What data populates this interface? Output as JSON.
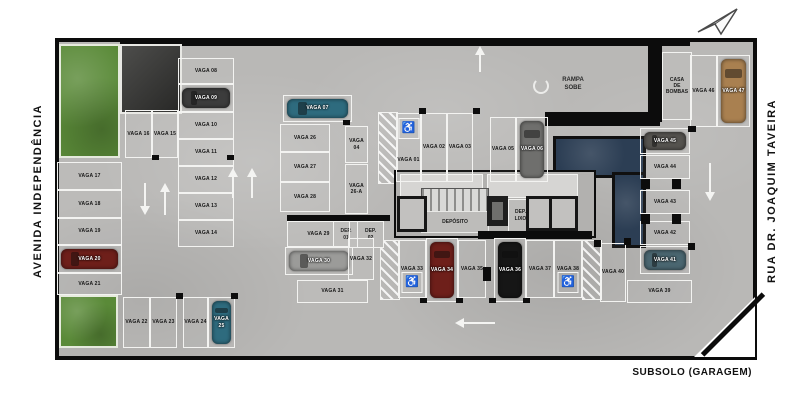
{
  "title": {
    "bottom_right": "SUBSOLO (GARAGEM)"
  },
  "streets": {
    "left": "AVENIDA INDEPENDÊNCIA",
    "right": "RUA DR. JOAQUIM TAVEIRA"
  },
  "labels": {
    "ramp_line1": "RAMPA",
    "ramp_line2": "SOBE",
    "pump_room_line1": "CASA",
    "pump_room_line2": "DE",
    "pump_room_line3": "BOMBAS",
    "deposito": "DEPÓSITO",
    "trash_line1": "DEP.",
    "trash_line2": "LIXO",
    "dep01_line1": "DEP.",
    "dep01_line2": "01",
    "dep02_line1": "DEP.",
    "dep02_line2": "02",
    "wheelchair_icon": "♿"
  },
  "colors": {
    "concrete": "#b9b8b6",
    "wall": "#0c0c0c",
    "grass": "#5a8a38",
    "water_tank": "#2c3e54",
    "space_line": "#f3f3f1",
    "car_red": "#6e1f1a",
    "car_teal": "#2e6b7e",
    "car_silver": "#9b9b99",
    "car_darkgray": "#3c3c3c",
    "car_black": "#161616",
    "car_tan": "#a98050",
    "car_steel": "#4a6670",
    "car_gray": "#6f6f6d",
    "car_darksilver": "#55534f"
  },
  "spaces": [
    {
      "label": "VAGA 01",
      "x": 396,
      "y": 113,
      "w": 25,
      "h": 69,
      "o": "v",
      "wc": "top"
    },
    {
      "label": "VAGA 02",
      "x": 421,
      "y": 113,
      "w": 26,
      "h": 69,
      "o": "v"
    },
    {
      "label": "VAGA 03",
      "x": 447,
      "y": 113,
      "w": 26,
      "h": 69,
      "o": "v"
    },
    {
      "label": "VAGA 04",
      "x": 345,
      "y": 126,
      "w": 23,
      "h": 37,
      "o": "v"
    },
    {
      "label": "VAGA 05",
      "x": 490,
      "y": 117,
      "w": 26,
      "h": 65,
      "o": "v"
    },
    {
      "label": "VAGA 06",
      "x": 516,
      "y": 117,
      "w": 32,
      "h": 65,
      "o": "v",
      "car": "car_gray"
    },
    {
      "label": "VAGA 07",
      "x": 283,
      "y": 95,
      "w": 69,
      "h": 27,
      "o": "h",
      "car": "car_teal"
    },
    {
      "label": "VAGA 08",
      "x": 178,
      "y": 58,
      "w": 56,
      "h": 26,
      "o": "h"
    },
    {
      "label": "VAGA 09",
      "x": 178,
      "y": 84,
      "w": 56,
      "h": 28,
      "o": "h",
      "car": "car_darkgray"
    },
    {
      "label": "VAGA 10",
      "x": 178,
      "y": 112,
      "w": 56,
      "h": 27,
      "o": "h"
    },
    {
      "label": "VAGA 11",
      "x": 178,
      "y": 139,
      "w": 56,
      "h": 27,
      "o": "h"
    },
    {
      "label": "VAGA 12",
      "x": 178,
      "y": 166,
      "w": 56,
      "h": 27,
      "o": "h"
    },
    {
      "label": "VAGA 13",
      "x": 178,
      "y": 193,
      "w": 56,
      "h": 27,
      "o": "h"
    },
    {
      "label": "VAGA 14",
      "x": 178,
      "y": 220,
      "w": 56,
      "h": 27,
      "o": "h"
    },
    {
      "label": "VAGA 15",
      "x": 152,
      "y": 110,
      "w": 26,
      "h": 48,
      "o": "v"
    },
    {
      "label": "VAGA 16",
      "x": 125,
      "y": 110,
      "w": 27,
      "h": 48,
      "o": "v"
    },
    {
      "label": "VAGA 17",
      "x": 57,
      "y": 162,
      "w": 65,
      "h": 28,
      "o": "h"
    },
    {
      "label": "VAGA 18",
      "x": 57,
      "y": 190,
      "w": 65,
      "h": 28,
      "o": "h"
    },
    {
      "label": "VAGA 19",
      "x": 57,
      "y": 218,
      "w": 65,
      "h": 27,
      "o": "h"
    },
    {
      "label": "VAGA 20",
      "x": 57,
      "y": 245,
      "w": 65,
      "h": 28,
      "o": "h",
      "car": "car_red"
    },
    {
      "label": "VAGA 21",
      "x": 57,
      "y": 273,
      "w": 65,
      "h": 22,
      "o": "h"
    },
    {
      "label": "VAGA 22",
      "x": 123,
      "y": 297,
      "w": 27,
      "h": 51,
      "o": "v"
    },
    {
      "label": "VAGA 23",
      "x": 150,
      "y": 297,
      "w": 27,
      "h": 51,
      "o": "v"
    },
    {
      "label": "VAGA 24",
      "x": 183,
      "y": 297,
      "w": 25,
      "h": 51,
      "o": "v"
    },
    {
      "label": "VAGA 25",
      "x": 208,
      "y": 297,
      "w": 27,
      "h": 51,
      "o": "v",
      "car": "car_teal"
    },
    {
      "label": "VAGA 26",
      "x": 280,
      "y": 124,
      "w": 50,
      "h": 28,
      "o": "h"
    },
    {
      "label": "VAGA 26-A",
      "x": 345,
      "y": 164,
      "w": 23,
      "h": 50,
      "o": "v"
    },
    {
      "label": "VAGA 27",
      "x": 280,
      "y": 152,
      "w": 50,
      "h": 30,
      "o": "h"
    },
    {
      "label": "VAGA 28",
      "x": 280,
      "y": 182,
      "w": 50,
      "h": 30,
      "o": "h"
    },
    {
      "label": "VAGA 29",
      "x": 287,
      "y": 221,
      "w": 63,
      "h": 26,
      "o": "h"
    },
    {
      "label": "VAGA 30",
      "x": 285,
      "y": 247,
      "w": 68,
      "h": 28,
      "o": "h",
      "car": "car_silver"
    },
    {
      "label": "VAGA 31",
      "x": 297,
      "y": 280,
      "w": 71,
      "h": 23,
      "o": "h"
    },
    {
      "label": "VAGA 32",
      "x": 348,
      "y": 238,
      "w": 26,
      "h": 42,
      "o": "v"
    },
    {
      "label": "VAGA 33",
      "x": 398,
      "y": 240,
      "w": 28,
      "h": 58,
      "o": "v",
      "wc": "bottom"
    },
    {
      "label": "VAGA 34",
      "x": 426,
      "y": 238,
      "w": 32,
      "h": 64,
      "o": "v",
      "car": "car_red"
    },
    {
      "label": "VAGA 35",
      "x": 458,
      "y": 240,
      "w": 28,
      "h": 58,
      "o": "v"
    },
    {
      "label": "VAGA 36",
      "x": 494,
      "y": 238,
      "w": 32,
      "h": 64,
      "o": "v",
      "car": "car_black"
    },
    {
      "label": "VAGA 37",
      "x": 526,
      "y": 240,
      "w": 28,
      "h": 58,
      "o": "v"
    },
    {
      "label": "VAGA 38",
      "x": 554,
      "y": 240,
      "w": 28,
      "h": 58,
      "o": "v",
      "wc": "bottom"
    },
    {
      "label": "VAGA 39",
      "x": 627,
      "y": 280,
      "w": 65,
      "h": 23,
      "o": "h"
    },
    {
      "label": "VAGA 40",
      "x": 600,
      "y": 243,
      "w": 26,
      "h": 59,
      "o": "v"
    },
    {
      "label": "VAGA 41",
      "x": 640,
      "y": 246,
      "w": 50,
      "h": 28,
      "o": "h",
      "car": "car_steel"
    },
    {
      "label": "VAGA 42",
      "x": 640,
      "y": 221,
      "w": 50,
      "h": 24,
      "o": "h"
    },
    {
      "label": "VAGA 43",
      "x": 640,
      "y": 190,
      "w": 50,
      "h": 24,
      "o": "h"
    },
    {
      "label": "VAGA 44",
      "x": 640,
      "y": 155,
      "w": 50,
      "h": 24,
      "o": "h"
    },
    {
      "label": "VAGA 45",
      "x": 640,
      "y": 128,
      "w": 50,
      "h": 26,
      "o": "h",
      "car": "car_darksilver"
    },
    {
      "label": "VAGA 46",
      "x": 690,
      "y": 55,
      "w": 27,
      "h": 72,
      "o": "v"
    },
    {
      "label": "VAGA 47",
      "x": 717,
      "y": 55,
      "w": 33,
      "h": 72,
      "o": "v",
      "car": "car_tan"
    }
  ],
  "pillars": [
    [
      483,
      267,
      8,
      14
    ],
    [
      641,
      179,
      9,
      10
    ],
    [
      672,
      179,
      9,
      10
    ],
    [
      641,
      214,
      9,
      10
    ],
    [
      672,
      214,
      9,
      10
    ],
    [
      176,
      293,
      7,
      6
    ],
    [
      231,
      293,
      7,
      6
    ],
    [
      419,
      108,
      7,
      6
    ],
    [
      473,
      108,
      7,
      6
    ],
    [
      152,
      155,
      7,
      5
    ],
    [
      227,
      155,
      7,
      5
    ],
    [
      343,
      120,
      7,
      5
    ],
    [
      594,
      240,
      7,
      7
    ],
    [
      624,
      238,
      7,
      7
    ],
    [
      688,
      243,
      7,
      7
    ],
    [
      688,
      126,
      8,
      6
    ],
    [
      420,
      298,
      7,
      5
    ],
    [
      456,
      298,
      7,
      5
    ],
    [
      489,
      298,
      7,
      5
    ],
    [
      523,
      298,
      7,
      5
    ]
  ],
  "arrows": [
    {
      "x": 140,
      "y": 183,
      "l": 32,
      "d": "down"
    },
    {
      "x": 160,
      "y": 183,
      "l": 32,
      "d": "up"
    },
    {
      "x": 228,
      "y": 168,
      "l": 30,
      "d": "up"
    },
    {
      "x": 247,
      "y": 168,
      "l": 30,
      "d": "up"
    },
    {
      "x": 705,
      "y": 163,
      "l": 38,
      "d": "down"
    },
    {
      "x": 475,
      "y": 46,
      "l": 26,
      "d": "up"
    },
    {
      "x": 455,
      "y": 318,
      "l": 40,
      "d": "left"
    }
  ]
}
